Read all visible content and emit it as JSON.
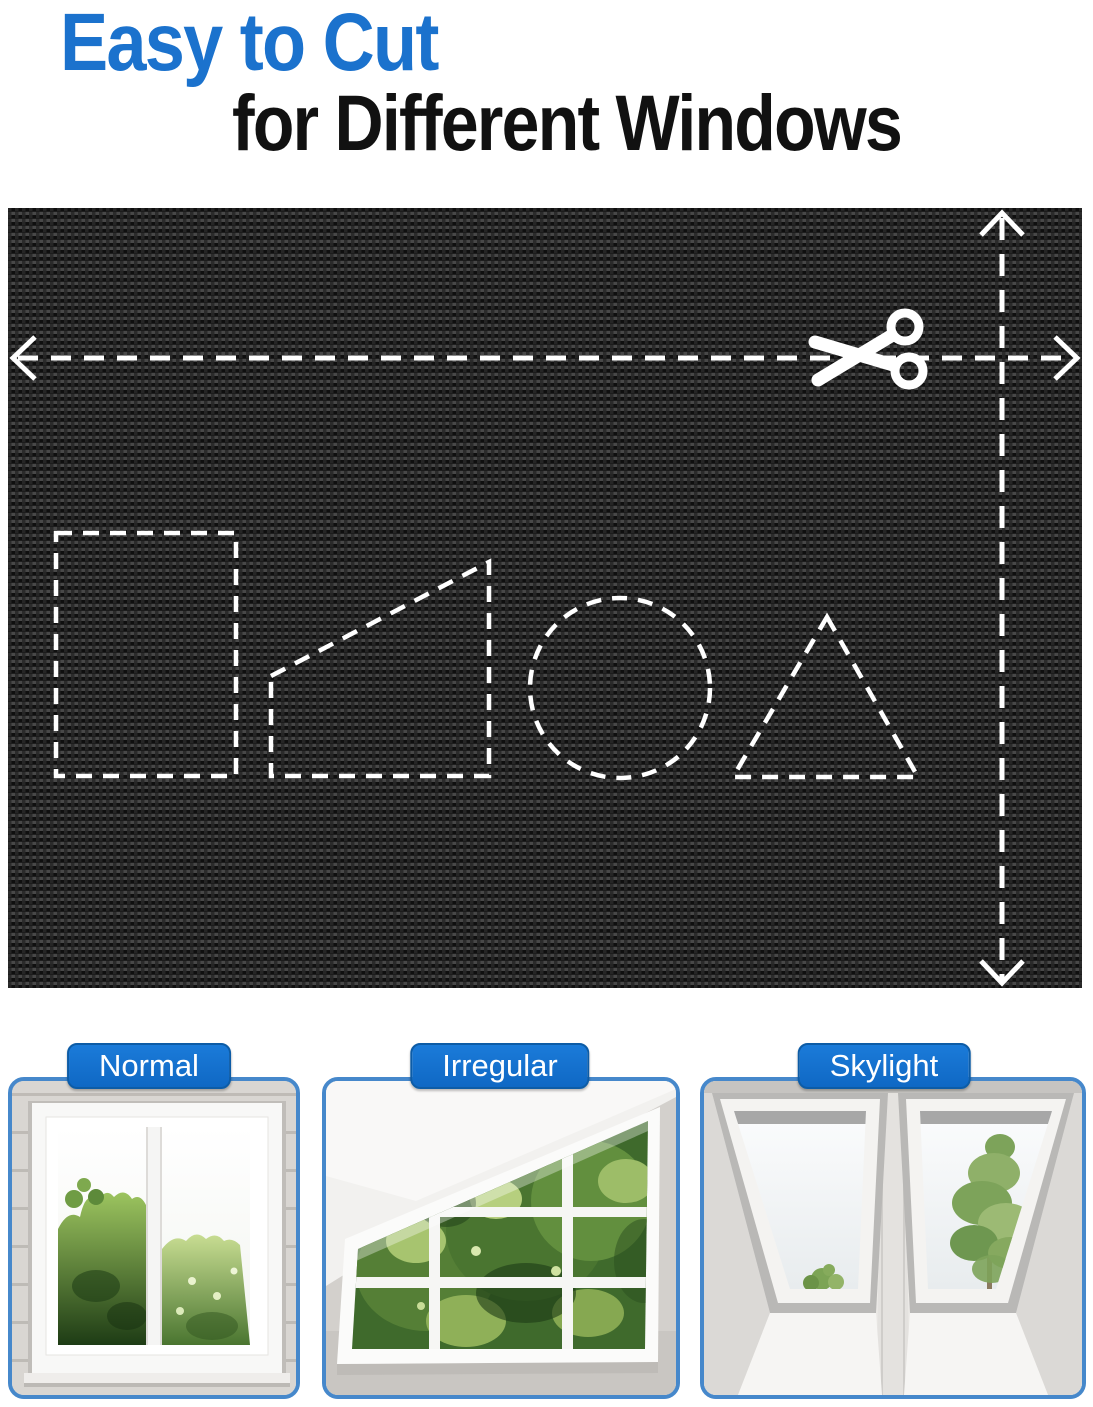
{
  "title": {
    "line1": "Easy to Cut",
    "line2": "for Different Windows"
  },
  "fabric_demo": {
    "description_icons": {
      "scissors": "scissors-icon",
      "horizontal_cut_line": "dashed-arrow-horizontal",
      "vertical_cut_line": "dashed-arrow-vertical"
    },
    "cut_shapes": [
      "rectangle",
      "right-trapezoid",
      "circle",
      "triangle"
    ]
  },
  "window_types": [
    {
      "label": "Normal"
    },
    {
      "label": "Irregular"
    },
    {
      "label": "Skylight"
    }
  ],
  "colors": {
    "title_blue": "#1b72cd",
    "title_black": "#111111",
    "badge_blue": "#1173d2",
    "badge_border": "#0d5ca6",
    "panel_border": "#4688cb",
    "fabric_base": "#232323",
    "dash_white": "#ffffff"
  }
}
